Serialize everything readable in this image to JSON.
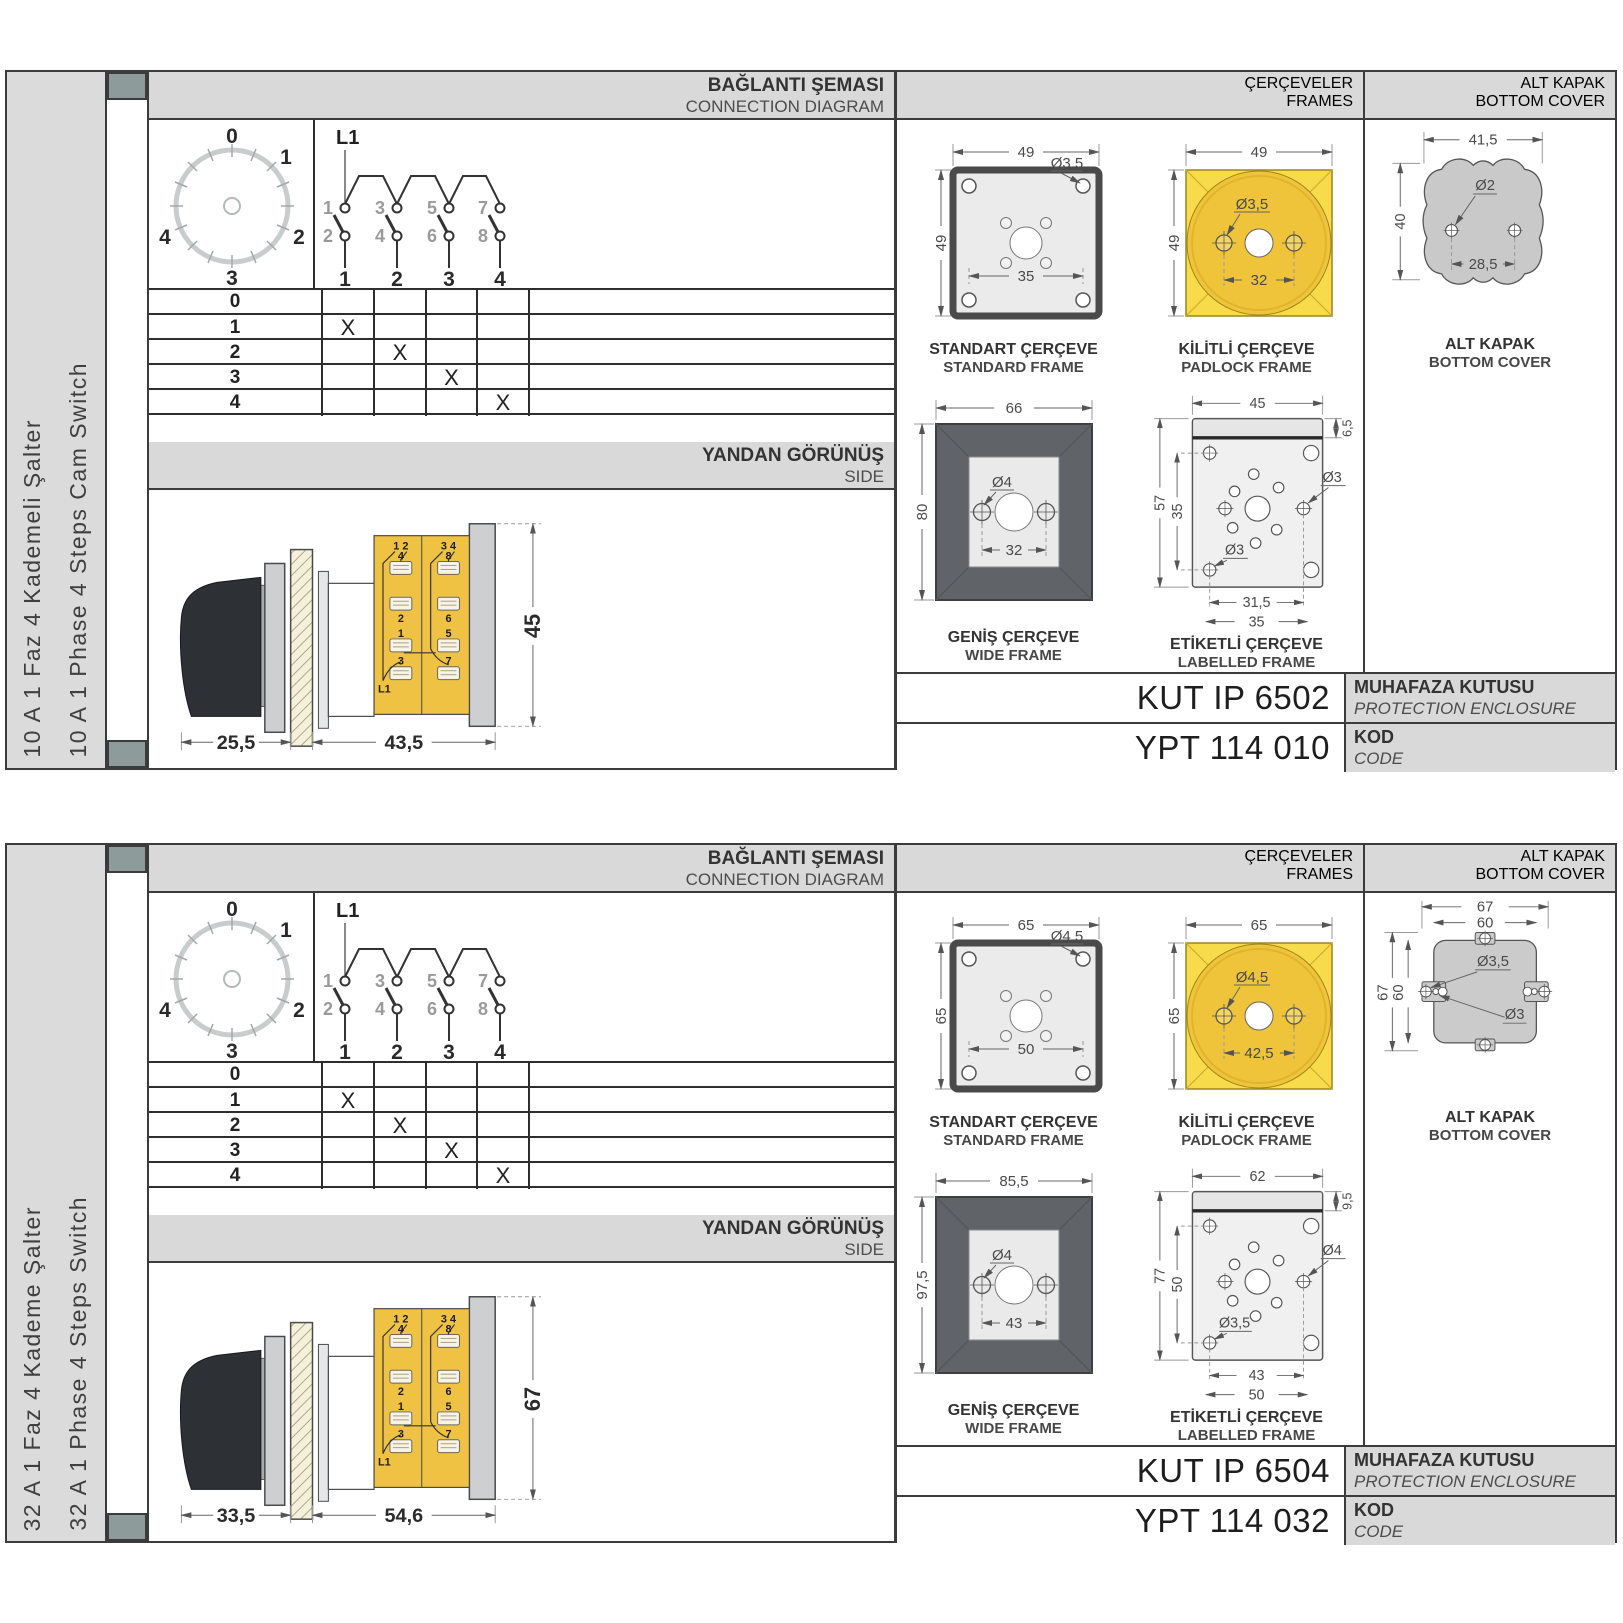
{
  "theme": {
    "accent_yellow": "#F0C244",
    "padlock_yellow": "#F8DB4B",
    "panel_gray": "#D9D9D9",
    "frame_dark": "#606468",
    "cover_gray": "#C9C9C9",
    "spine_teal": "#8D9C9A"
  },
  "sections": [
    {
      "product": {
        "title_tr": "10 A 1 Faz 4 Kademeli Şalter",
        "title_en": "10 A 1 Phase 4 Steps Cam Switch"
      },
      "connection": {
        "header_tr": "BAĞLANTI ŞEMASI",
        "header_en": "CONNECTION DIAGRAM",
        "dial": {
          "positions": [
            "0",
            "1",
            "2",
            "3",
            "4"
          ]
        },
        "feed": "L1",
        "contacts_top": [
          "1",
          "3",
          "5",
          "7"
        ],
        "contacts_bottom": [
          "2",
          "4",
          "6",
          "8"
        ],
        "switches": [
          "1",
          "2",
          "3",
          "4"
        ],
        "table": {
          "rows": [
            {
              "label": "0",
              "marks": [
                "",
                "",
                "",
                ""
              ]
            },
            {
              "label": "1",
              "marks": [
                "X",
                "",
                "",
                ""
              ]
            },
            {
              "label": "2",
              "marks": [
                "",
                "X",
                "",
                ""
              ]
            },
            {
              "label": "3",
              "marks": [
                "",
                "",
                "X",
                ""
              ]
            },
            {
              "label": "4",
              "marks": [
                "",
                "",
                "",
                "X"
              ]
            }
          ]
        }
      },
      "side_view": {
        "header_tr": "YANDAN GÖRÜNÜŞ",
        "header_en": "SIDE",
        "dims": {
          "handle_depth": "25,5",
          "body_depth": "43,5",
          "height": "45"
        },
        "terminals": {
          "left_header": "1 2",
          "right_header": "3 4",
          "left": [
            "4",
            "2",
            "1",
            "3"
          ],
          "right": [
            "8",
            "6",
            "5",
            "7"
          ],
          "feed": "L1"
        }
      },
      "frames": {
        "header_tr": "ÇERÇEVELER",
        "header_en": "FRAMES",
        "standard": {
          "cap_tr": "STANDART ÇERÇEVE",
          "cap_en": "STANDARD FRAME",
          "w": "49",
          "h": "49",
          "hole": "Ø3,5",
          "inner": "35"
        },
        "padlock": {
          "cap_tr": "KİLİTLİ ÇERÇEVE",
          "cap_en": "PADLOCK FRAME",
          "w": "49",
          "h": "49",
          "hole": "Ø3,5",
          "inner": "32"
        },
        "wide": {
          "cap_tr": "GENİŞ ÇERÇEVE",
          "cap_en": "WIDE FRAME",
          "w": "66",
          "h": "80",
          "hole": "Ø4",
          "inner": "32"
        },
        "labelled": {
          "cap_tr": "ETİKETLİ ÇERÇEVE",
          "cap_en": "LABELLED FRAME",
          "w": "45",
          "tab": "6,5",
          "h": "57",
          "inner_h": "35",
          "hole_right": "Ø3",
          "hole_left": "Ø3",
          "inner_w": "31,5",
          "outer_w": "35"
        }
      },
      "cover": {
        "header_tr": "ALT KAPAK",
        "header_en": "BOTTOM COVER",
        "cap_tr": "ALT KAPAK",
        "cap_en": "BOTTOM COVER",
        "w": "41,5",
        "h": "40",
        "hole": "Ø2",
        "inner": "28,5"
      },
      "enclosure": {
        "value": "KUT IP 6502",
        "label_tr": "MUHAFAZA KUTUSU",
        "label_en": "PROTECTION ENCLOSURE"
      },
      "code": {
        "value": "YPT 114 010",
        "label_tr": "KOD",
        "label_en": "CODE"
      }
    },
    {
      "product": {
        "title_tr": "32 A 1 Faz 4 Kademe Şalter",
        "title_en": "32 A 1 Phase 4 Steps Switch"
      },
      "connection": {
        "header_tr": "BAĞLANTI ŞEMASI",
        "header_en": "CONNECTION DIAGRAM",
        "dial": {
          "positions": [
            "0",
            "1",
            "2",
            "3",
            "4"
          ]
        },
        "feed": "L1",
        "contacts_top": [
          "1",
          "3",
          "5",
          "7"
        ],
        "contacts_bottom": [
          "2",
          "4",
          "6",
          "8"
        ],
        "switches": [
          "1",
          "2",
          "3",
          "4"
        ],
        "table": {
          "rows": [
            {
              "label": "0",
              "marks": [
                "",
                "",
                "",
                ""
              ]
            },
            {
              "label": "1",
              "marks": [
                "X",
                "",
                "",
                ""
              ]
            },
            {
              "label": "2",
              "marks": [
                "",
                "X",
                "",
                ""
              ]
            },
            {
              "label": "3",
              "marks": [
                "",
                "",
                "X",
                ""
              ]
            },
            {
              "label": "4",
              "marks": [
                "",
                "",
                "",
                "X"
              ]
            }
          ]
        }
      },
      "side_view": {
        "header_tr": "YANDAN GÖRÜNÜŞ",
        "header_en": "SIDE",
        "dims": {
          "handle_depth": "33,5",
          "body_depth": "54,6",
          "height": "67"
        },
        "terminals": {
          "left_header": "1 2",
          "right_header": "3 4",
          "left": [
            "4",
            "2",
            "1",
            "3"
          ],
          "right": [
            "8",
            "6",
            "5",
            "7"
          ],
          "feed": "L1"
        }
      },
      "frames": {
        "header_tr": "ÇERÇEVELER",
        "header_en": "FRAMES",
        "standard": {
          "cap_tr": "STANDART ÇERÇEVE",
          "cap_en": "STANDARD FRAME",
          "w": "65",
          "h": "65",
          "hole": "Ø4,5",
          "inner": "50"
        },
        "padlock": {
          "cap_tr": "KİLİTLİ ÇERÇEVE",
          "cap_en": "PADLOCK FRAME",
          "w": "65",
          "h": "65",
          "hole": "Ø4,5",
          "inner": "42,5"
        },
        "wide": {
          "cap_tr": "GENİŞ ÇERÇEVE",
          "cap_en": "WIDE FRAME",
          "w": "85,5",
          "h": "97,5",
          "hole": "Ø4",
          "inner": "43"
        },
        "labelled": {
          "cap_tr": "ETİKETLİ ÇERÇEVE",
          "cap_en": "LABELLED FRAME",
          "w": "62",
          "tab": "9,5",
          "h": "77",
          "inner_h": "50",
          "hole_right": "Ø4",
          "hole_left": "Ø3,5",
          "inner_w": "43",
          "outer_w": "50"
        }
      },
      "cover": {
        "header_tr": "ALT KAPAK",
        "header_en": "BOTTOM COVER",
        "cap_tr": "ALT KAPAK",
        "cap_en": "BOTTOM COVER",
        "outer_w": "67",
        "inner_w": "60",
        "outer_h": "67",
        "inner_h": "60",
        "hole_big": "Ø3,5",
        "hole_small": "Ø3"
      },
      "enclosure": {
        "value": "KUT IP 6504",
        "label_tr": "MUHAFAZA KUTUSU",
        "label_en": "PROTECTION ENCLOSURE"
      },
      "code": {
        "value": "YPT 114 032",
        "label_tr": "KOD",
        "label_en": "CODE"
      }
    }
  ]
}
